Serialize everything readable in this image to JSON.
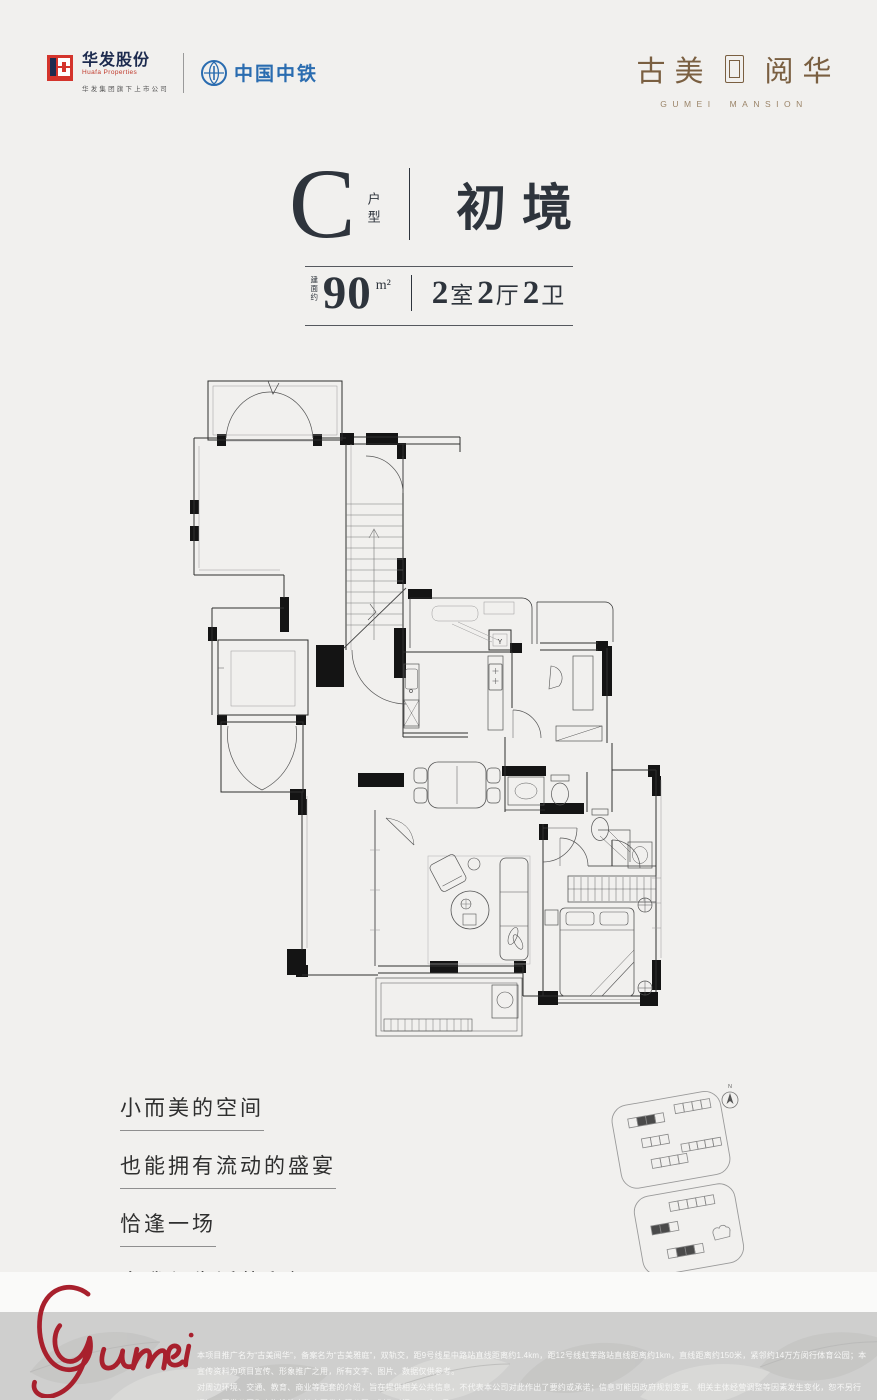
{
  "header": {
    "huafa": {
      "cn": "华发股份",
      "en": "Huafa Properties",
      "tagline": "华发集团旗下上市公司"
    },
    "crec": {
      "cn": "中国中铁"
    },
    "brand": {
      "cn_left": "古美",
      "cn_right": "阅华",
      "en_word1": "GUMEI",
      "en_word2": "MANSION"
    }
  },
  "title": {
    "letter": "C",
    "letter_label": "户型",
    "name": "初境",
    "area_prefix": "建面约",
    "area": "90",
    "area_unit": "m²",
    "rooms": [
      {
        "n": "2",
        "t": "室"
      },
      {
        "n": "2",
        "t": "厅"
      },
      {
        "n": "2",
        "t": "卫"
      }
    ]
  },
  "floorplan": {
    "flue_label": "Y"
  },
  "quote": {
    "lines": [
      "小而美的空间",
      "也能拥有流动的盛宴",
      "恰逢一场",
      "自我与生活的和解"
    ]
  },
  "siteplan": {
    "north_label": "N"
  },
  "signature": {
    "text": "Gumei"
  },
  "footer": {
    "line1": "本项目推广名为“古美阅华”，备案名为“古美雅庭”，双轨交，距9号线星中路站直线距离约1.4km，距12号线虹莘路站直线距离约1km，直线距离约150米，紧邻约14万方闵行体育公园；本宣传资料为项目宣传、形象推广之用，所有文字、图片、数据仅供参考。",
    "line2": "对周边环境、交通、教育、商业等配套的介绍，旨在提供相关公共信息，不代表本公司对此作出了要约或承诺；信息可能因政府规划变更、相关主体经营调整等因素发生变化，恕不另行通知；开发公司为上海桦怡房地产开发有限公司，制作时间2024年7月。"
  },
  "colors": {
    "ink": "#2e343c",
    "brand_brown": "#7a5f41",
    "huafa_red": "#d4342c",
    "huafa_navy": "#1d2b4f",
    "crec_blue": "#2a6cb0",
    "signature_red": "#a8202d",
    "band_gray": "#cfcfce"
  }
}
